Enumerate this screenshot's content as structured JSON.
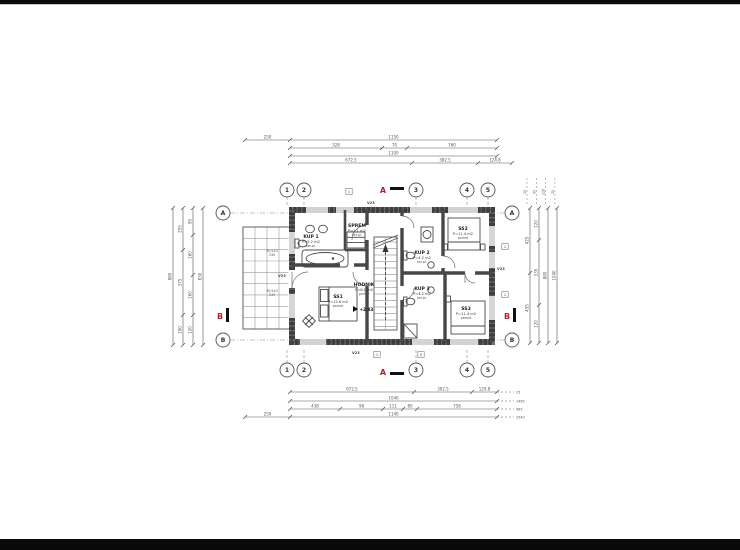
{
  "colors": {
    "red": "#b22222",
    "ink": "#3f3f3f",
    "line": "#6a6a6a",
    "light": "#8a8a8a",
    "bg": "#ffffff",
    "letterbox": "#0a0a0a"
  },
  "axis_bubbles": {
    "columns": [
      "1",
      "2",
      "3",
      "4",
      "5"
    ],
    "rows": [
      "A",
      "B"
    ]
  },
  "section_markers": {
    "horizontal": "A",
    "vertical": "B"
  },
  "rooms": [
    {
      "id": "kup1",
      "name": "KUP 1",
      "area": "P=5.2 m2",
      "floor": "ker.pl."
    },
    {
      "id": "sprem",
      "name": "SPREM",
      "area": "P=2.1 m2",
      "floor": "ker.pl."
    },
    {
      "id": "ss1",
      "name": "SS1",
      "area": "P=12.6 m2",
      "floor": "parket"
    },
    {
      "id": "hodnik",
      "name": "HODNIK",
      "area": "P=6.1 m2",
      "floor": "parket"
    },
    {
      "id": "kup2",
      "name": "KUP 2",
      "area": "P=4.2 m2",
      "floor": "ker.pl."
    },
    {
      "id": "kup3",
      "name": "KUP 3",
      "area": "P=4.2 m2",
      "floor": "ker.pl."
    },
    {
      "id": "ss2",
      "name": "SS2",
      "area": "P=11.4 m2",
      "floor": "parket"
    },
    {
      "id": "ss3",
      "name": "SS3",
      "area": "P=11.4 m2",
      "floor": "parket"
    }
  ],
  "level_mark": "+2.83",
  "opening_labels": [
    "V23",
    "V23",
    "V23",
    "V23"
  ],
  "window_tags": [
    "1",
    "1",
    "5",
    "1",
    "1"
  ],
  "terrace_window_specs": [
    [
      "90/140",
      "240"
    ],
    [
      "90/140",
      "240"
    ]
  ],
  "dimensions": {
    "top": [
      [
        "250",
        "1150"
      ],
      [
        "328",
        "70",
        "760"
      ],
      [
        "1100"
      ],
      [
        "672.5",
        "382.5",
        "124.8"
      ]
    ],
    "bottom": [
      [
        "672.5",
        "392.5",
        "129.8"
      ],
      [
        "1040"
      ],
      [
        "438",
        "98",
        "111",
        "80",
        "758"
      ],
      [
        "250",
        "1140"
      ]
    ],
    "bottom_right_totals": [
      "25",
      "1465",
      "465",
      "2540"
    ],
    "left": [
      [
        "880"
      ],
      [
        "255",
        "375",
        "190"
      ],
      [
        "95",
        "160",
        "160",
        "120"
      ],
      [
        "830"
      ]
    ],
    "right": [
      [
        "425",
        "455"
      ],
      [
        "120",
        "335",
        "120"
      ],
      [
        "880"
      ],
      [
        "1040"
      ]
    ],
    "right_top_marks": [
      "25",
      "95",
      "120",
      "25"
    ]
  }
}
